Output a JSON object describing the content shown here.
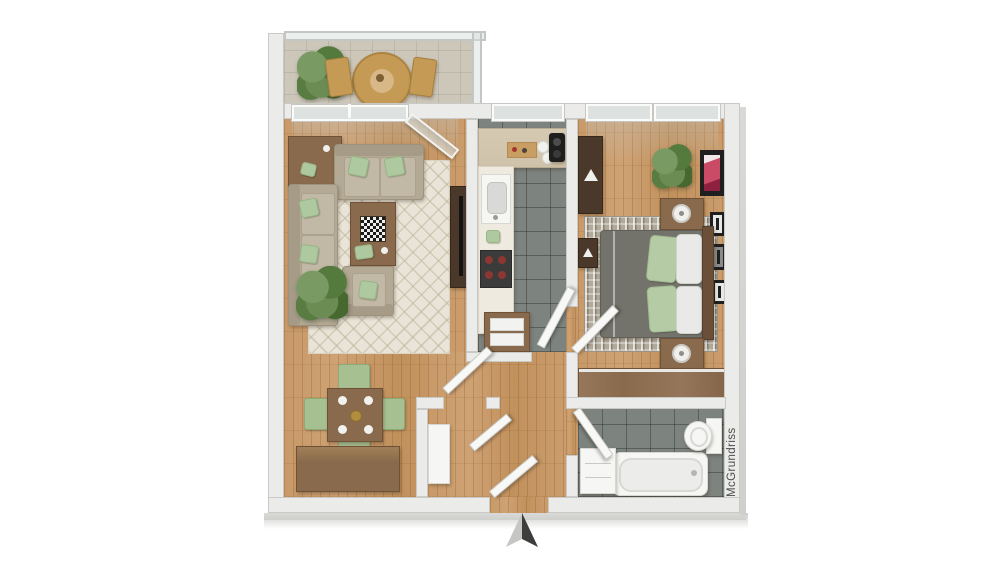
{
  "watermark": {
    "text": "McGrundriss"
  },
  "compass": {
    "icon": "north-arrow",
    "light_color": "#c6c6c4",
    "dark_color": "#3d3d3b"
  },
  "palette": {
    "background": "#ffffff",
    "wall": "#ebebe9",
    "wall_shadow": "#cfcfcc",
    "wood_floor": "#c89a69",
    "tile_floor": "#7d837f",
    "balcony_floor": "#cdc7ba",
    "living_rug": "#e9e4d7",
    "bedroom_rug": "#b1a99a",
    "sofa_beige": "#b3a994",
    "pillow_green": "#aec8a0",
    "wood_furniture": "#8a6a4c",
    "dark_wood": "#4a382a",
    "bed_duvet": "#73736b",
    "white_fixture": "#f6f6f4",
    "plant_green": "#557a3e",
    "dining_chair_green": "#a7c092",
    "art_pink": "#c94b66",
    "art_red": "#8e3330",
    "tv_black": "#141414"
  },
  "rooms": {
    "balcony": {
      "items": [
        "plant",
        "bistro-table",
        "chair",
        "chair",
        "glass-railing"
      ]
    },
    "living_room": {
      "items": [
        "sideboard",
        "loveseat",
        "sofa",
        "armchair",
        "coffee-table",
        "chessboard",
        "area-rug",
        "plant",
        "tv-console",
        "tv",
        "wall-art"
      ]
    },
    "dining_area": {
      "items": [
        "dining-table",
        "chair",
        "chair",
        "chair",
        "chair",
        "sideboard",
        "plates",
        "bowl"
      ]
    },
    "kitchen": {
      "items": [
        "counter",
        "sink",
        "cooktop",
        "coffee-machine",
        "cutting-board",
        "drawer-cabinet"
      ]
    },
    "bedroom": {
      "items": [
        "double-bed",
        "pillows",
        "nightstand",
        "nightstand",
        "table-lamp",
        "table-lamp",
        "area-rug",
        "dresser",
        "wardrobe",
        "plant",
        "picture-frames"
      ]
    },
    "bathroom": {
      "items": [
        "bathtub",
        "toilet",
        "cabinet"
      ]
    },
    "hallway": {
      "items": [
        "entrance-door",
        "interior-doors",
        "cabinet"
      ]
    }
  }
}
